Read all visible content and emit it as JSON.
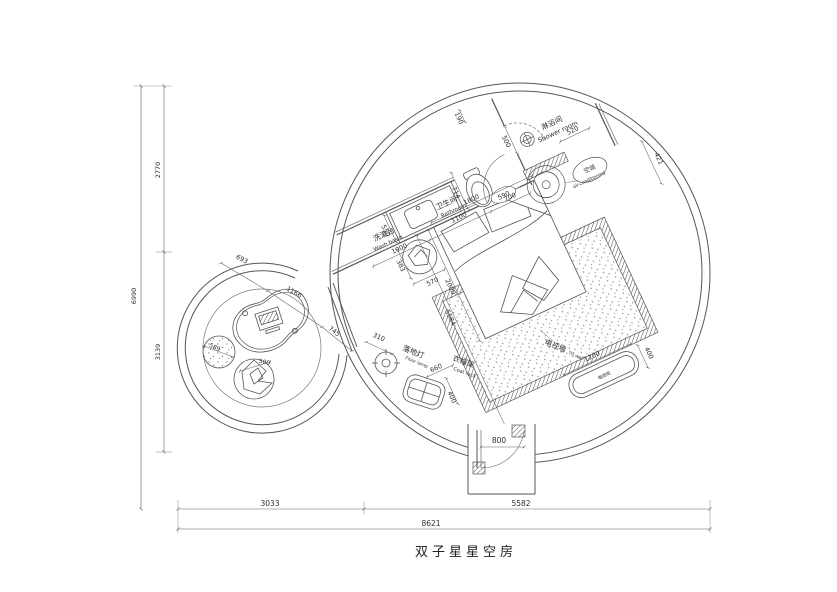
{
  "plan": {
    "title": "双子星星空房",
    "dims": {
      "v_total": "6990",
      "v_top": "2770",
      "v_bottom": "3139",
      "h_total": "8621",
      "h_left": "3033",
      "h_right": "5582",
      "bath_1000": "1000",
      "bath_1100": "1100",
      "bath_700": "700",
      "bath_190": "190",
      "bath_550": "550",
      "bath_714": "714",
      "bath_door": "590",
      "shower_door": "500",
      "shower_520": "520",
      "ac_421": "421",
      "bed_w": "1800",
      "bed_l": "2000",
      "diag": "5584",
      "stool_a": "383",
      "stool_b": "570",
      "lamp": "310",
      "rack_660": "660",
      "rack_400": "400",
      "tv_1200": "1200",
      "tv_400": "400",
      "entry": "800",
      "lounge_693": "693",
      "lounge_1166": "1166",
      "lounge_745": "745",
      "pouf": "589",
      "beanbag": "500"
    },
    "labels": {
      "washbasin_cn": "洗漱台",
      "washbasin_en": "Wash basin",
      "bathroom_cn": "卫生间",
      "bathroom_en": "Bathroom",
      "shower_cn": "淋浴间",
      "shower_en": "Shower room",
      "ac_cn": "空调",
      "ac_en": "air-conditioning",
      "lamp_cn": "落地灯",
      "lamp_en": "Floor lamp",
      "rack_cn": "衣帽架",
      "rack_en": "Coat rack",
      "tv_cn": "电视墙",
      "tv_en": "TV wall",
      "cabinet": "电视柜"
    }
  }
}
